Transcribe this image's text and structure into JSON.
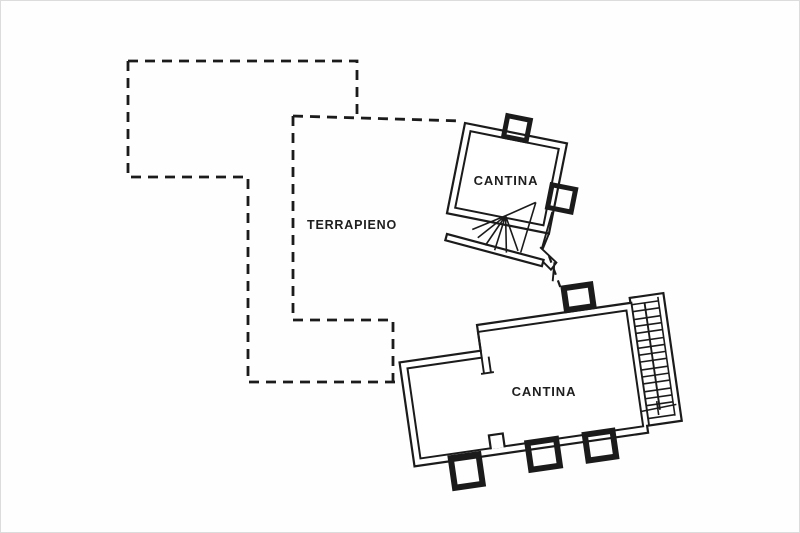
{
  "canvas": {
    "width": 800,
    "height": 533,
    "background_color": "#fefefe",
    "line_color": "#1b1b1b",
    "text_color": "#1f1f1f",
    "frame_color": "#dcdcdc"
  },
  "labels": {
    "terrapieno": "TERRAPIENO",
    "cantina_upper": "CANTINA",
    "cantina_lower": "CANTINA"
  },
  "features": {
    "dashed_outline": "terrain-boundary-dashed-outline",
    "upper_building": "small-cantina-with-winder-stair",
    "lower_building": "large-cantina-with-straight-stair",
    "stair_treads_count": 15
  }
}
